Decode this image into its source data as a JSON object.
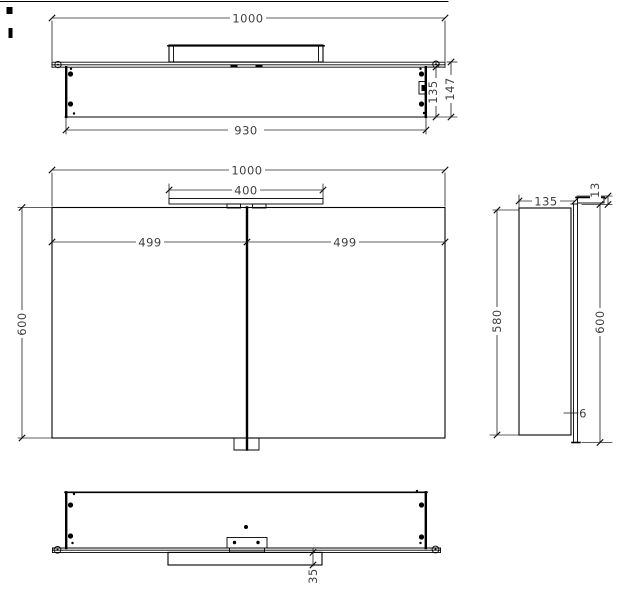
{
  "meta": {
    "background_color": "#ffffff",
    "line_color": "#000000",
    "text_color": "#3f3f3f"
  },
  "views": {
    "top": {
      "dims": {
        "overall_width": "1000",
        "body_width": "930",
        "body_depth": "135",
        "overall_depth": "147"
      }
    },
    "front": {
      "dims": {
        "overall_width": "1000",
        "light_width": "400",
        "left_half": "499",
        "right_half": "499",
        "height": "600"
      }
    },
    "side": {
      "dims": {
        "depth": "135",
        "light_height": "13",
        "body_height": "580",
        "mirror_height": "600",
        "mirror_thickness": "6"
      }
    },
    "bottom": {
      "dims": {
        "light_depth": "35"
      }
    }
  }
}
